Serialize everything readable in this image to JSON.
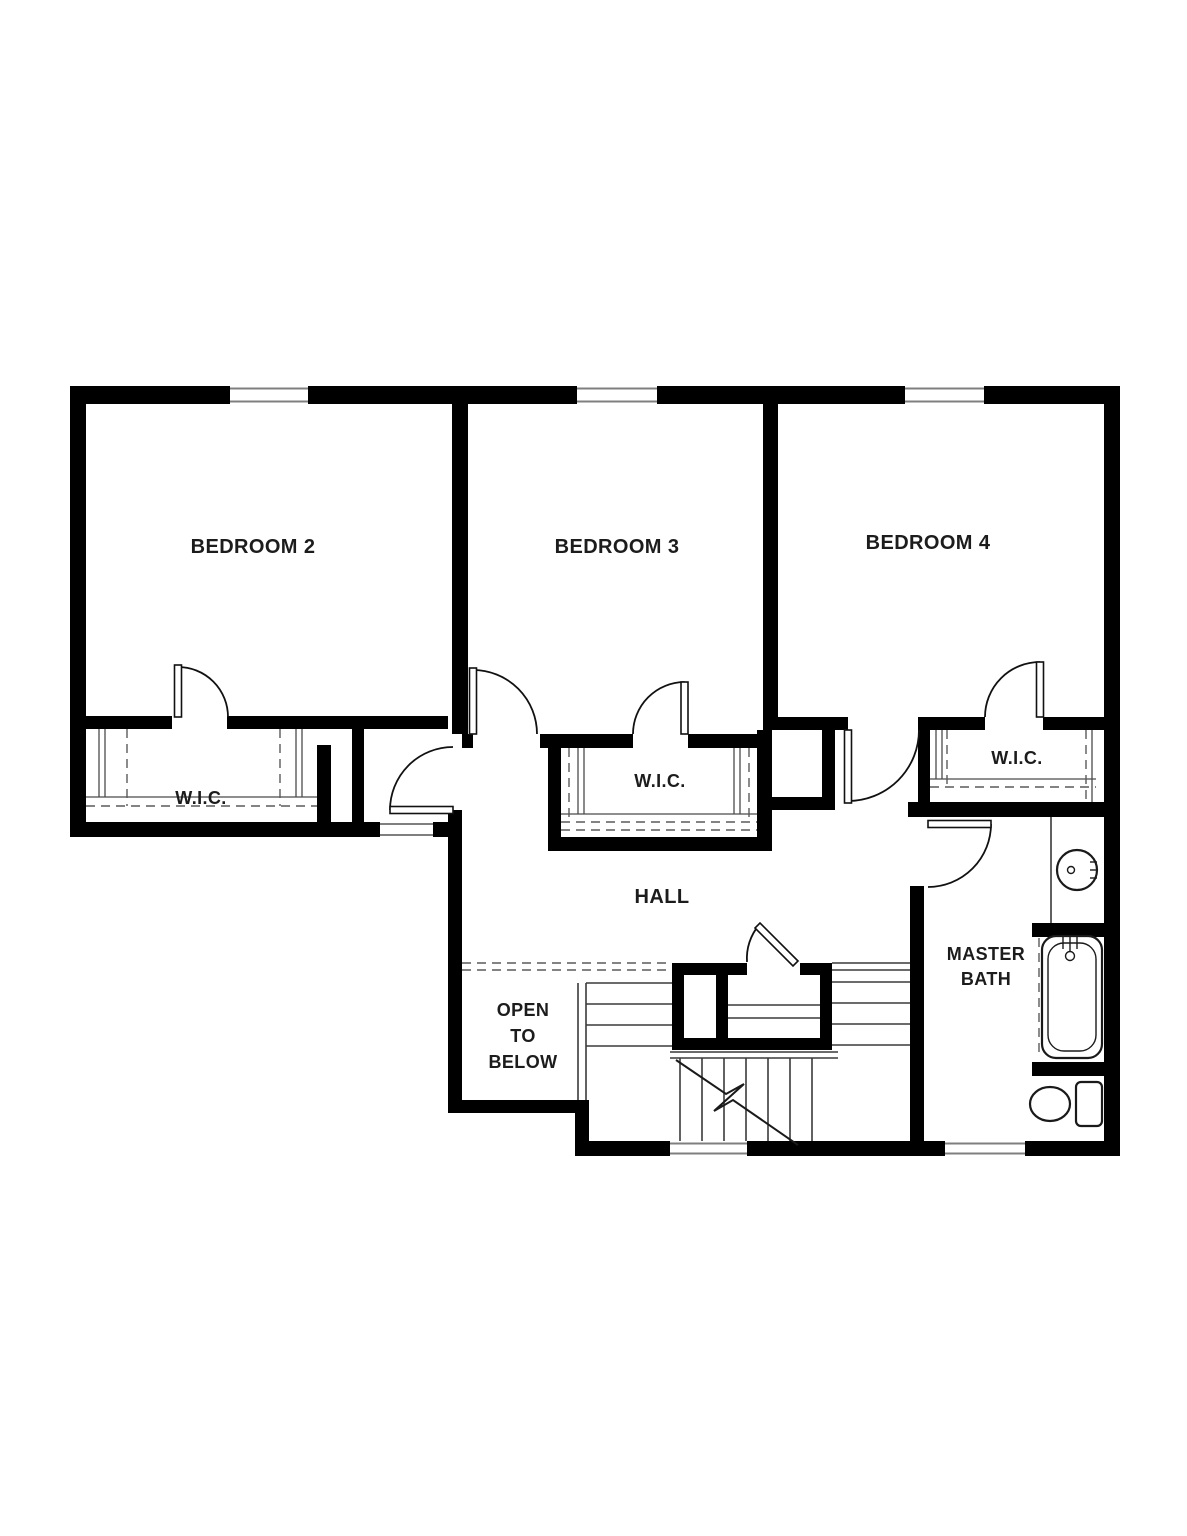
{
  "document": {
    "kind": "residential floor plan drawing",
    "floor": "upper floor"
  },
  "rooms": [
    {
      "id": "bedroom-2",
      "label": "BEDROOM 2"
    },
    {
      "id": "bedroom-3",
      "label": "BEDROOM 3"
    },
    {
      "id": "bedroom-4",
      "label": "BEDROOM 4"
    },
    {
      "id": "wic-bedroom-2",
      "label": "W.I.C."
    },
    {
      "id": "wic-bedroom-3",
      "label": "W.I.C."
    },
    {
      "id": "wic-bedroom-4",
      "label": "W.I.C."
    },
    {
      "id": "hall",
      "label": "HALL"
    },
    {
      "id": "open-to-below",
      "label_lines": [
        "OPEN",
        "TO",
        "BELOW"
      ]
    },
    {
      "id": "master-bath",
      "label_lines": [
        "MASTER",
        "BATH"
      ]
    }
  ],
  "fixtures": [
    {
      "name": "sink"
    },
    {
      "name": "bathtub"
    },
    {
      "name": "toilet"
    },
    {
      "name": "staircase"
    }
  ],
  "features": {
    "windows": 6,
    "doors": 8,
    "stair_break_line": true
  },
  "colors": {
    "background": "#ffffff",
    "wall": "#000000",
    "thin_line": "#3a3a3a",
    "dashed_line": "#5a5a5a",
    "window_line": "#7f7f7f",
    "label_text": "#1c1c1c"
  }
}
